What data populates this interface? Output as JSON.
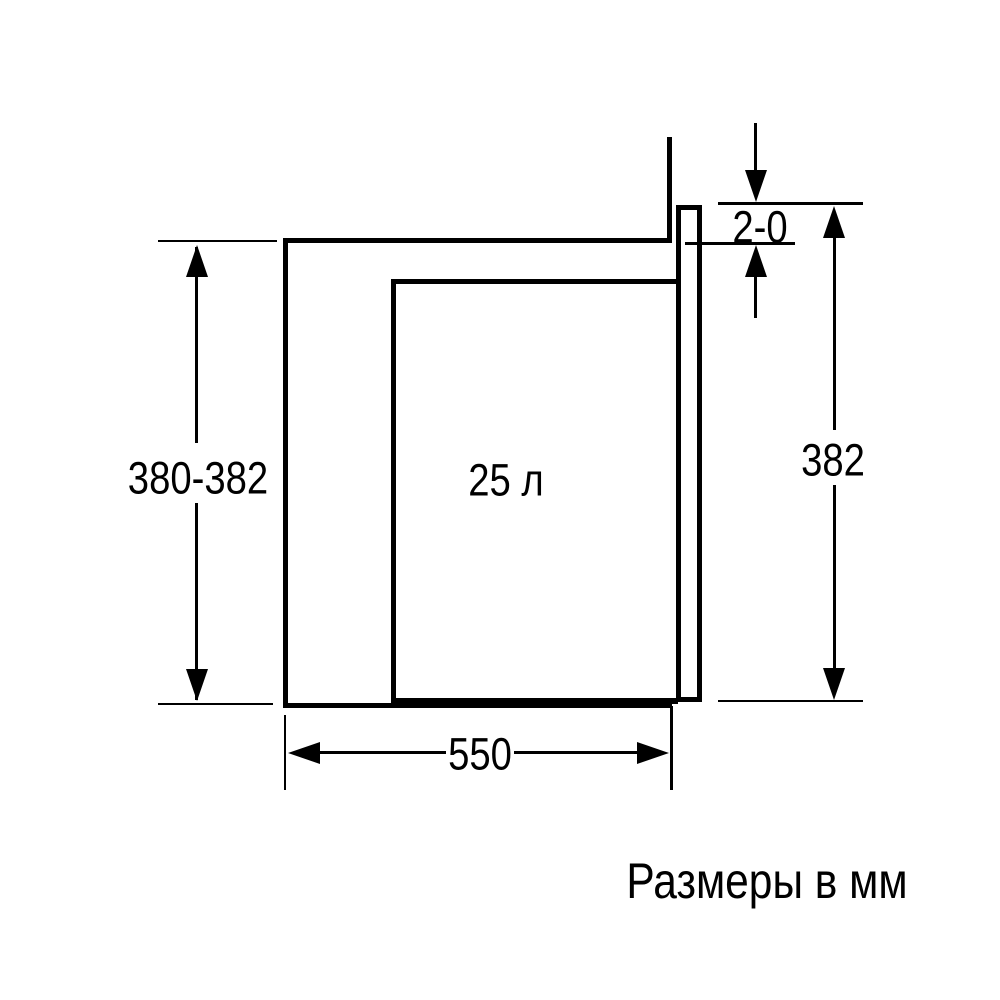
{
  "diagram": {
    "caption": "Размеры в мм",
    "labels": {
      "capacity": "25 л",
      "niche_height": "380-382",
      "front_clearance": "2-0",
      "appliance_height": "382",
      "niche_width": "550"
    },
    "colors": {
      "line": "#000000",
      "background": "#ffffff"
    }
  }
}
